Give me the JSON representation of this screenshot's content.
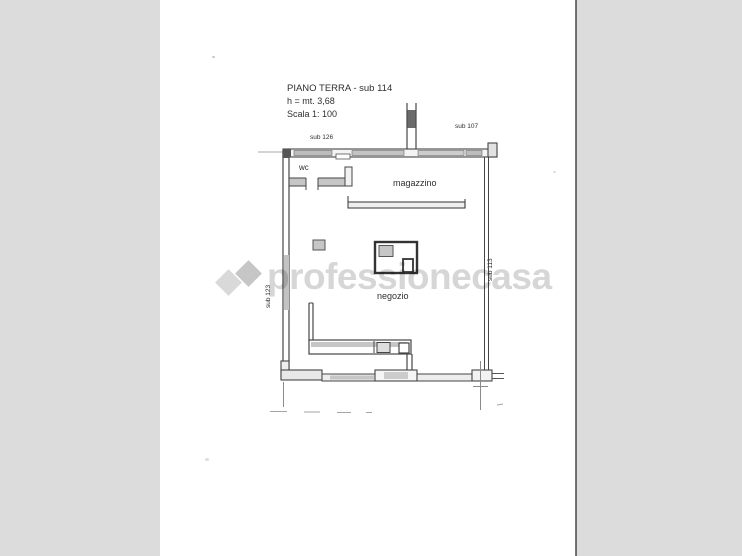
{
  "header": {
    "title": "PIANO TERRA - sub 114",
    "height_note": "h = mt. 3,68",
    "scale_note": "Scala 1: 100"
  },
  "labels": {
    "sub_top_left": "sub 126",
    "sub_top_right": "sub 107",
    "sub_left": "sub 123",
    "sub_right": "sub 113",
    "room_wc": "wc",
    "room_magazzino": "magazzino",
    "room_negozio": "negozio"
  },
  "watermark": {
    "text": "professionecasa",
    "logo_icon": "overlapping-diamonds-icon",
    "text_color": "#bdbdbd",
    "diamond_light_color": "#d9d9d9",
    "diamond_dark_color": "#c6c6c6"
  },
  "colors": {
    "background": "#dcdcdc",
    "paper": "#ffffff",
    "wall_line": "#3f3f3f",
    "wall_fill": "#c6c6c6"
  }
}
